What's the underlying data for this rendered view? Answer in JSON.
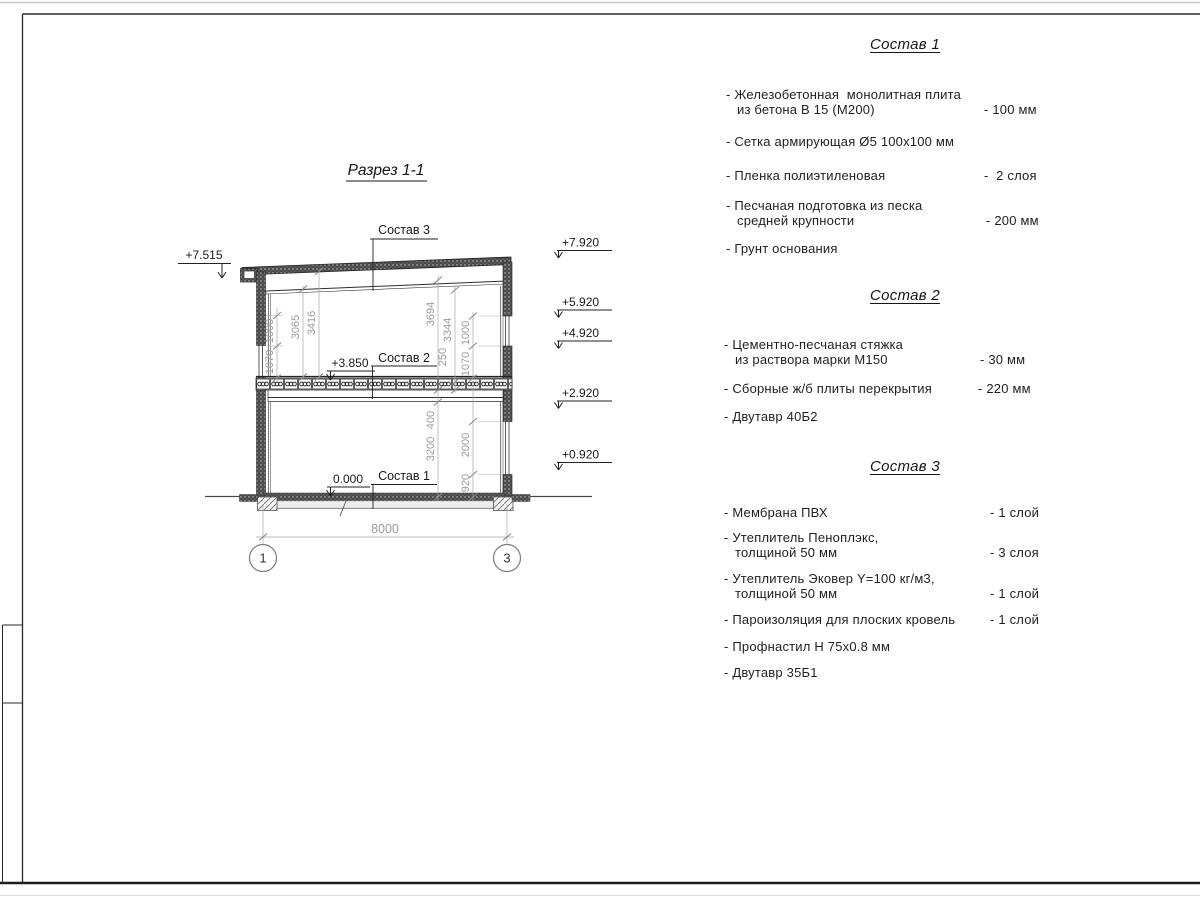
{
  "drawing": {
    "title": "Разрез 1-1",
    "refs": {
      "s1": "Состав 1",
      "s2": "Состав 2",
      "s3": "Состав 3"
    },
    "marks": {
      "eaves": "+7.515",
      "roof": "+7.920",
      "w2top": "+5.920",
      "w2sill": "+4.920",
      "c1": "+2.920",
      "w1sill": "+0.920",
      "floor": "+3.850",
      "zero": "0.000"
    },
    "dims": {
      "l1000": "1000",
      "l1070": "1070",
      "l3065": "3065",
      "l3416": "3416",
      "r3694": "3694",
      "r3344": "3344",
      "r250": "250",
      "r1000": "1000",
      "r1070": "1070",
      "r400": "400",
      "r3200": "3200",
      "r2000": "2000",
      "r920": "920",
      "span": "8000"
    },
    "axes": {
      "a1": "1",
      "a3": "3"
    }
  },
  "compositions": [
    {
      "title": "Состав 1",
      "items": [
        {
          "l1": "- Железобетонная  монолитная плита",
          "l2": "из бетона В 15 (М200)",
          "val": "- 100 мм"
        },
        {
          "l1": "- Сетка армирующая Ø5 100x100 мм",
          "l2": "",
          "val": ""
        },
        {
          "l1": "- Пленка полиэтиленовая",
          "l2": "",
          "val": "-  2 слоя"
        },
        {
          "l1": "- Песчаная подготовка из песка",
          "l2": "средней крупности",
          "val": "- 200 мм"
        },
        {
          "l1": "- Грунт основания",
          "l2": "",
          "val": ""
        }
      ]
    },
    {
      "title": "Состав 2",
      "items": [
        {
          "l1": "- Цементно-песчаная стяжка",
          "l2": "из раствора марки М150",
          "val": "- 30 мм"
        },
        {
          "l1": "- Сборные ж/б плиты перекрытия",
          "l2": "",
          "val": "- 220 мм"
        },
        {
          "l1": "- Двутавр 40Б2",
          "l2": "",
          "val": ""
        }
      ]
    },
    {
      "title": "Состав 3",
      "items": [
        {
          "l1": "- Мембрана ПВХ",
          "l2": "",
          "val": "- 1 слой"
        },
        {
          "l1": "- Утеплитель Пеноплэкс,",
          "l2": "толщиной 50 мм",
          "val": "- 3 слоя"
        },
        {
          "l1": "- Утеплитель Эковер Y=100 кг/м3,",
          "l2": "толщиной 50 мм",
          "val": "- 1 слой"
        },
        {
          "l1": "- Пароизоляция для плоских кровель",
          "l2": "",
          "val": "- 1 слой"
        },
        {
          "l1": "- Профнастил Н 75x0.8 мм",
          "l2": "",
          "val": ""
        },
        {
          "l1": "- Двутавр 35Б1",
          "l2": "",
          "val": ""
        }
      ]
    }
  ]
}
